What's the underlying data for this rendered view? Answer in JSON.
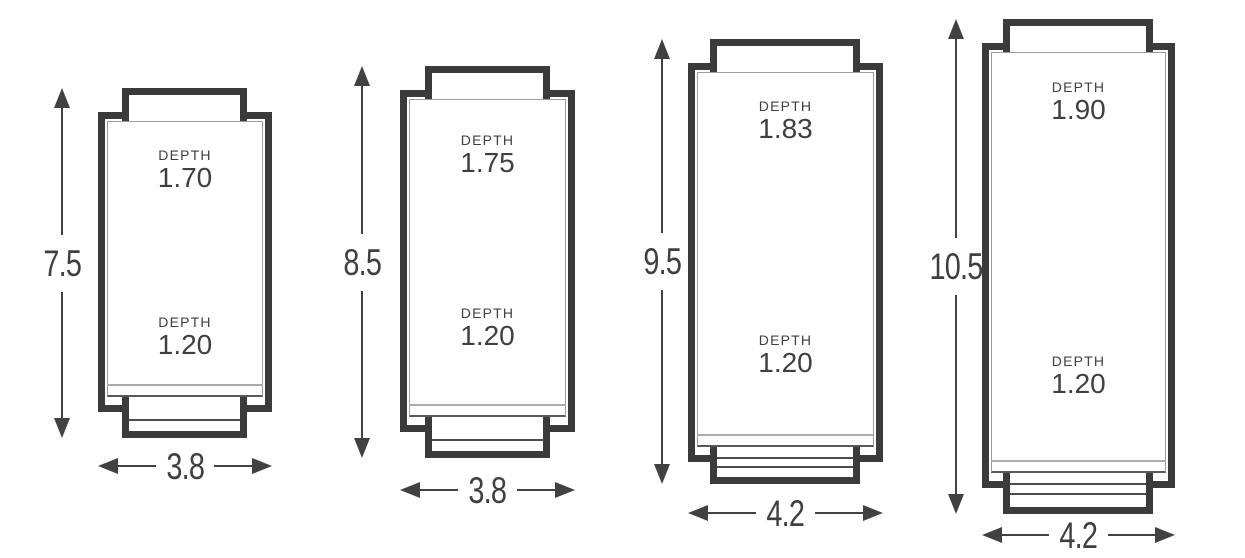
{
  "colors": {
    "outline_dark": "#3b3b3d",
    "thin_line_gray": "#9c9c9e",
    "inner_bottom_line": "#58585a",
    "text": "#3f3f41",
    "background": "#ffffff"
  },
  "icons": {
    "up_arrowhead": "solid-triangle-up",
    "down_arrowhead": "solid-triangle-down",
    "left_arrowhead": "solid-triangle-left",
    "right_arrowhead": "solid-triangle-right"
  },
  "figures": [
    {
      "height_dim": "7.5",
      "width_dim": "3.8",
      "depths": [
        {
          "label": "DEPTH",
          "value": "1.70"
        },
        {
          "label": "DEPTH",
          "value": "1.20"
        }
      ]
    },
    {
      "height_dim": "8.5",
      "width_dim": "3.8",
      "depths": [
        {
          "label": "DEPTH",
          "value": "1.75"
        },
        {
          "label": "DEPTH",
          "value": "1.20"
        }
      ]
    },
    {
      "height_dim": "9.5",
      "width_dim": "4.2",
      "depths": [
        {
          "label": "DEPTH",
          "value": "1.83"
        },
        {
          "label": "DEPTH",
          "value": "1.20"
        }
      ]
    },
    {
      "height_dim": "10.5",
      "width_dim": "4.2",
      "depths": [
        {
          "label": "DEPTH",
          "value": "1.90"
        },
        {
          "label": "DEPTH",
          "value": "1.20"
        }
      ]
    }
  ]
}
